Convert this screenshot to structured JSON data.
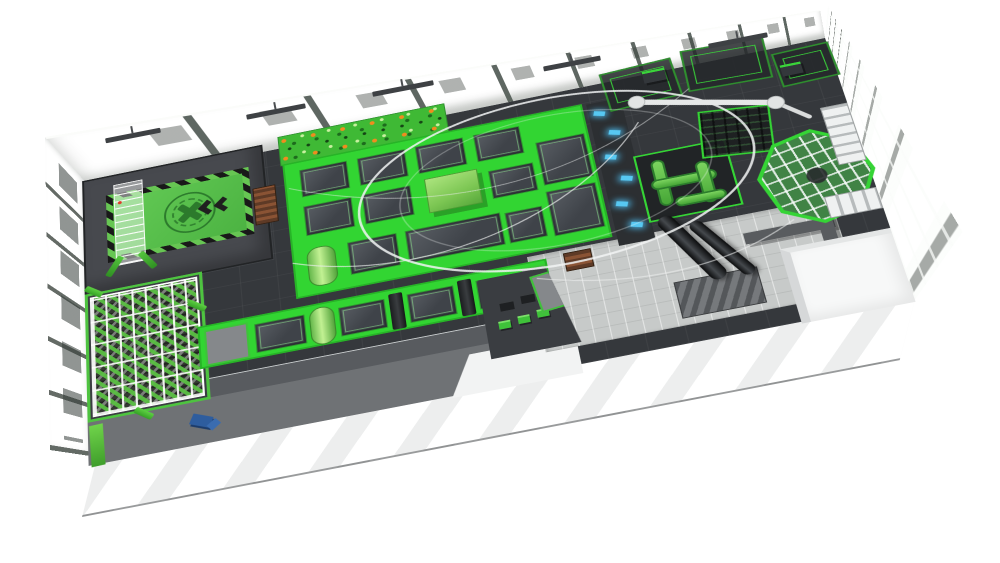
{
  "scene": {
    "title": "Indoor trampoline park — 3D isometric floor-plan render",
    "render_style": "photorealistic 3D architectural visualization, bird's-eye view",
    "background_color": "#ffffff",
    "text_visible": "none"
  },
  "palette": {
    "accent_green_bright": "#32d532",
    "accent_green_frame": "#27b427",
    "airbag_green": "#5ec653",
    "hazard_black": "#1f1f1f",
    "deck_dark_gray": "#35383c",
    "platform_gray": "#47494e",
    "corridor_gray": "#6f7275",
    "walkway_light_gray": "#c7cac9",
    "wall_light": "#e9ece6",
    "glass_green_tint": "#c4cfc0",
    "structure_white": "#f4f6f5",
    "wood_brown": "#7c4a30",
    "interactive_blue": "#57c8f2",
    "bench_blue": "#2e5d9e",
    "slide_black": "#16181a",
    "climb_hold_orange": "#f08c1e"
  },
  "zones": {
    "stunt_jump": {
      "label": "Stunt-jump platform: green airbag with X target, chevrons and truss tower"
    },
    "wood_stairs": {
      "label": "Wooden access stairs"
    },
    "climbing_wall": {
      "label": "Climbing wall with colored holds"
    },
    "main_court": {
      "label": "Main trampoline court",
      "small_beds": 12,
      "large_beds": 2,
      "features": "jump box, green roller"
    },
    "interactive_targets": {
      "label": "Interactive glowing light targets",
      "count": 6
    },
    "soft_play": {
      "label": "Soft-play green pipe maze in netted cage"
    },
    "ninja_cage": {
      "label": "Netted climbing cage"
    },
    "ropes_course": {
      "label": "Elevated ropes / ninja course structures"
    },
    "sky_track": {
      "label": "Circular overhead zipline track with rotating arm"
    },
    "spiral_tower": {
      "label": "Octagonal spiral slide tower with staircases"
    },
    "tube_slides": {
      "label": "Black tube slides",
      "count": 2
    },
    "foam_pit": {
      "label": "Foam cube pit under white truss grid"
    },
    "tumbling_lane": {
      "label": "Trampoline lane with roller and wedge obstacles",
      "beds": 4
    },
    "parkour_blocks": {
      "label": "Parkour practice blocks and landing mat"
    },
    "walkway": {
      "label": "Light tiled visitor walkway with steps"
    },
    "side_rooms": {
      "label": "Back-of-house rooms (bottom right)"
    },
    "entrance_corridor": {
      "label": "Glass-railed entrance corridor"
    },
    "bench": {
      "label": "Blue bench"
    },
    "building": {
      "label": "White industrial hall with green-tinted glazing and roof slats"
    }
  }
}
